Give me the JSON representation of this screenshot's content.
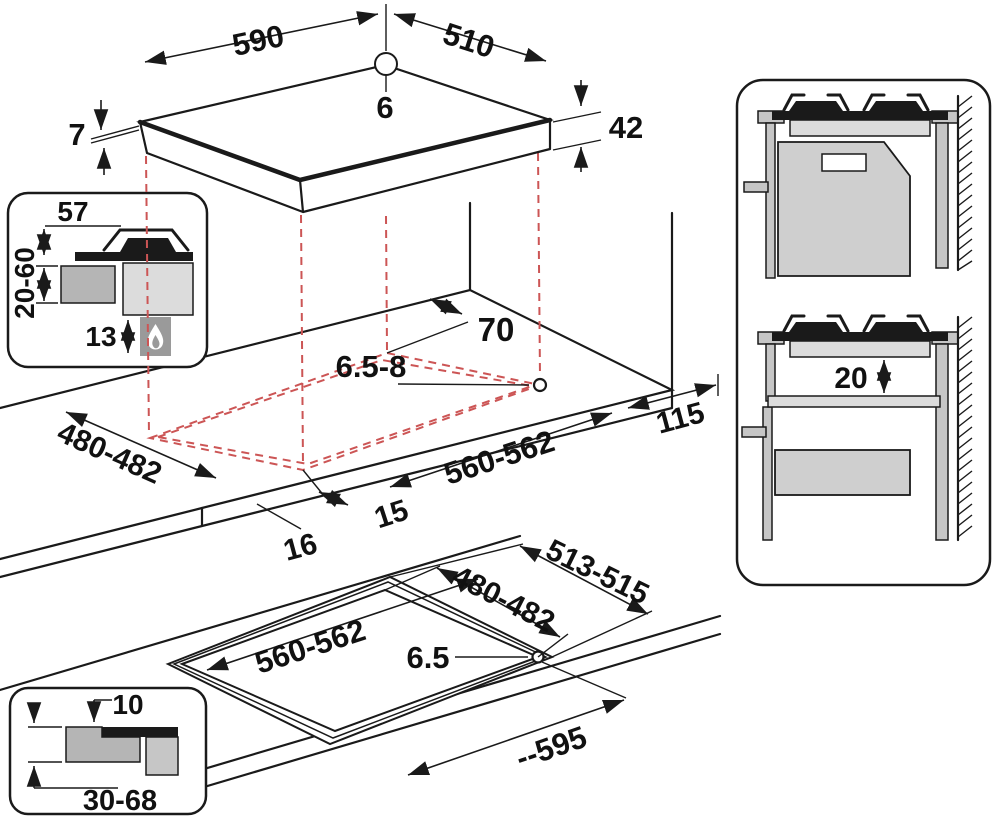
{
  "diagram": {
    "title": "hob-installation-dimensions",
    "colors": {
      "line": "#1a1a1a",
      "dashed_projection": "#cc5555",
      "worktop_gray": "#b5b5b5",
      "body_gray": "#dcdcdc",
      "panel_gray": "#c6c6c6",
      "background": "#ffffff"
    },
    "top_view": {
      "width": "590",
      "depth": "510",
      "hole_diameter": "6",
      "glass_thickness": "7",
      "body_height": "42"
    },
    "cutout_view": {
      "rear_clearance": "70",
      "hole_diameter": "6.5-8",
      "cutout_depth": "480-482",
      "front_clearance": "16",
      "side_clearance": "15",
      "cutout_width": "560-562",
      "right_clearance": "115"
    },
    "flush_view": {
      "frame_width": "513-515",
      "cutout_depth": "480-482",
      "cutout_width": "560-562",
      "hole_diameter": "6.5",
      "overall_width": "--595"
    },
    "section_inset": {
      "grate_height": "57",
      "worktop_thickness": "20-60",
      "bottom_clearance": "13",
      "icon": "gas-flame"
    },
    "flush_inset": {
      "step_depth": "10",
      "worktop_thickness": "30-68"
    },
    "side_inset": {
      "shelf_gap": "20"
    }
  }
}
